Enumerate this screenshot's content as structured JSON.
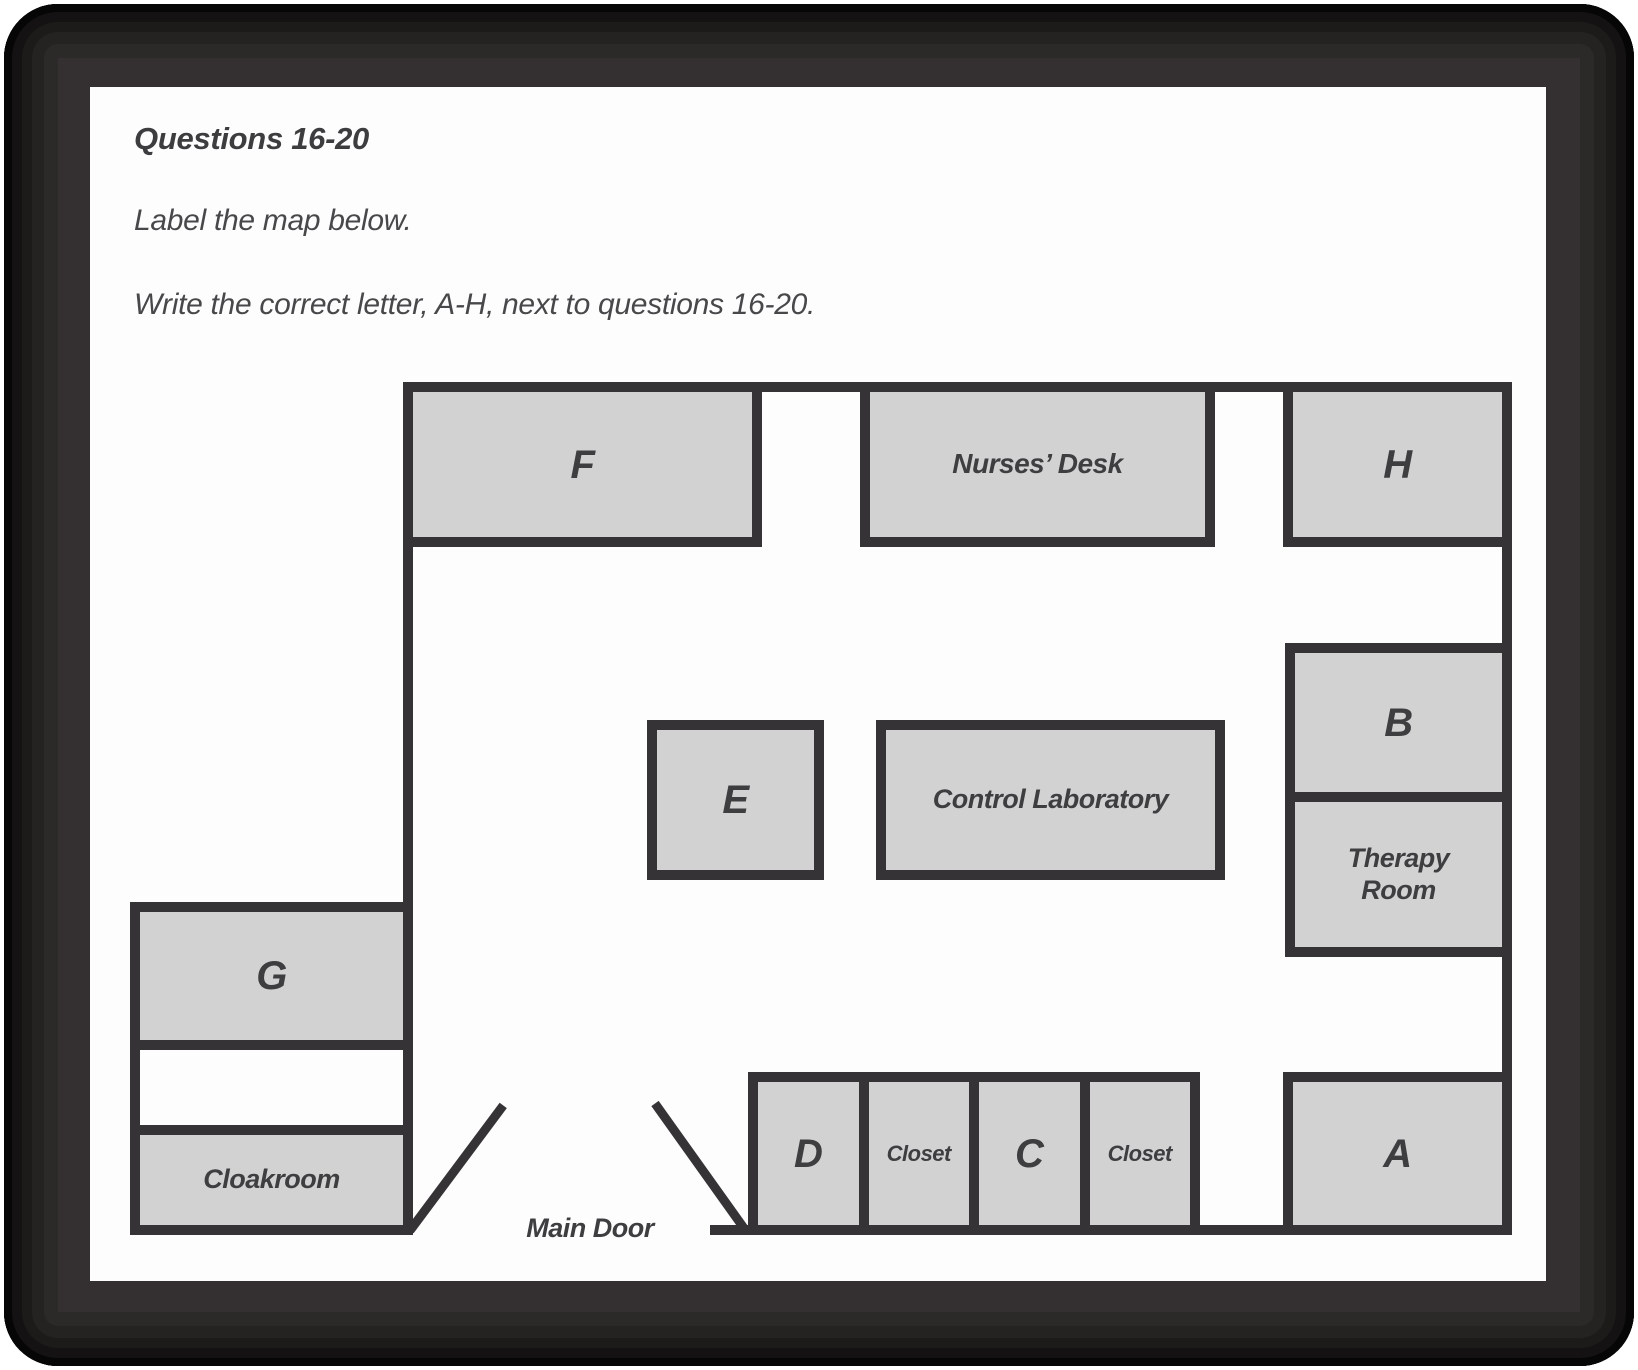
{
  "header": {
    "title": "Questions 16-20",
    "instruction1": "Label the map below.",
    "instruction2": "Write the correct letter, A-H, next to questions 16-20."
  },
  "map": {
    "rooms": {
      "f": "F",
      "nurses_desk": "Nurses’ Desk",
      "h": "H",
      "b": "B",
      "therapy_room": "Therapy Room",
      "e": "E",
      "control_laboratory": "Control Laboratory",
      "g": "G",
      "cloakroom": "Cloakroom",
      "a": "A",
      "d": "D",
      "closet_1": "Closet",
      "c": "C",
      "closet_2": "Closet"
    },
    "labels": {
      "main_door": "Main Door"
    },
    "colors": {
      "wall": "#363336",
      "room_fill": "#d2d2d3",
      "label_text": "#3e3e40",
      "frame": "#343031",
      "page_background": "#fdfdfd"
    }
  }
}
